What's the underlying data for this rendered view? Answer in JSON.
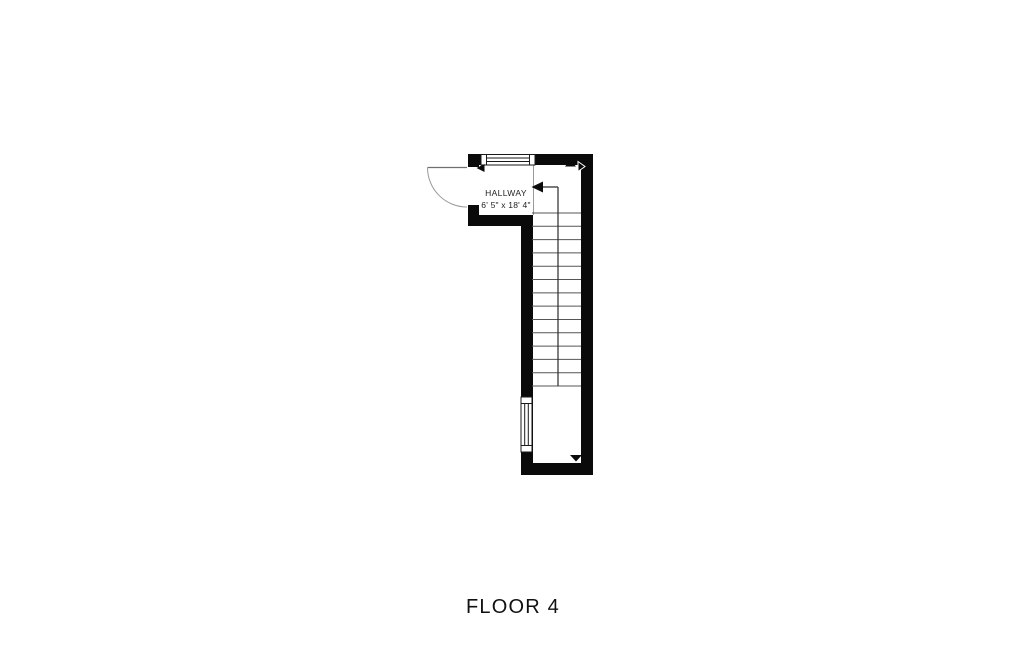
{
  "title": "FLOOR 4",
  "colors": {
    "wall": "#0a0a0a",
    "stair_line": "#555555",
    "text": "#1f1f1f",
    "background": "#ffffff"
  },
  "rooms": [
    {
      "name": "HALLWAY",
      "dimensions": "6' 5\" x 18' 4\""
    }
  ],
  "stairs": {
    "tread_count": 14,
    "direction": "arrow points left at top of run, rail line runs down stair center"
  },
  "features": [
    {
      "name": "entry-door",
      "type": "door with quarter-circle swing arc, opens outward to the left"
    },
    {
      "name": "top-window",
      "type": "window in top wall"
    },
    {
      "name": "left-window",
      "type": "window in lower-left wall"
    }
  ],
  "markers": [
    {
      "name": "stair-direction-arrow-icon",
      "glyph": "left-pointing triangle"
    },
    {
      "name": "opening-arrow-left-icon",
      "glyph": "left-pointing triangle"
    },
    {
      "name": "opening-arrow-up-icon",
      "glyph": "up-pointing triangle"
    },
    {
      "name": "opening-arrow-right-icon",
      "glyph": "right-pointing triangle"
    },
    {
      "name": "opening-arrow-down-icon",
      "glyph": "down-pointing triangle"
    }
  ]
}
